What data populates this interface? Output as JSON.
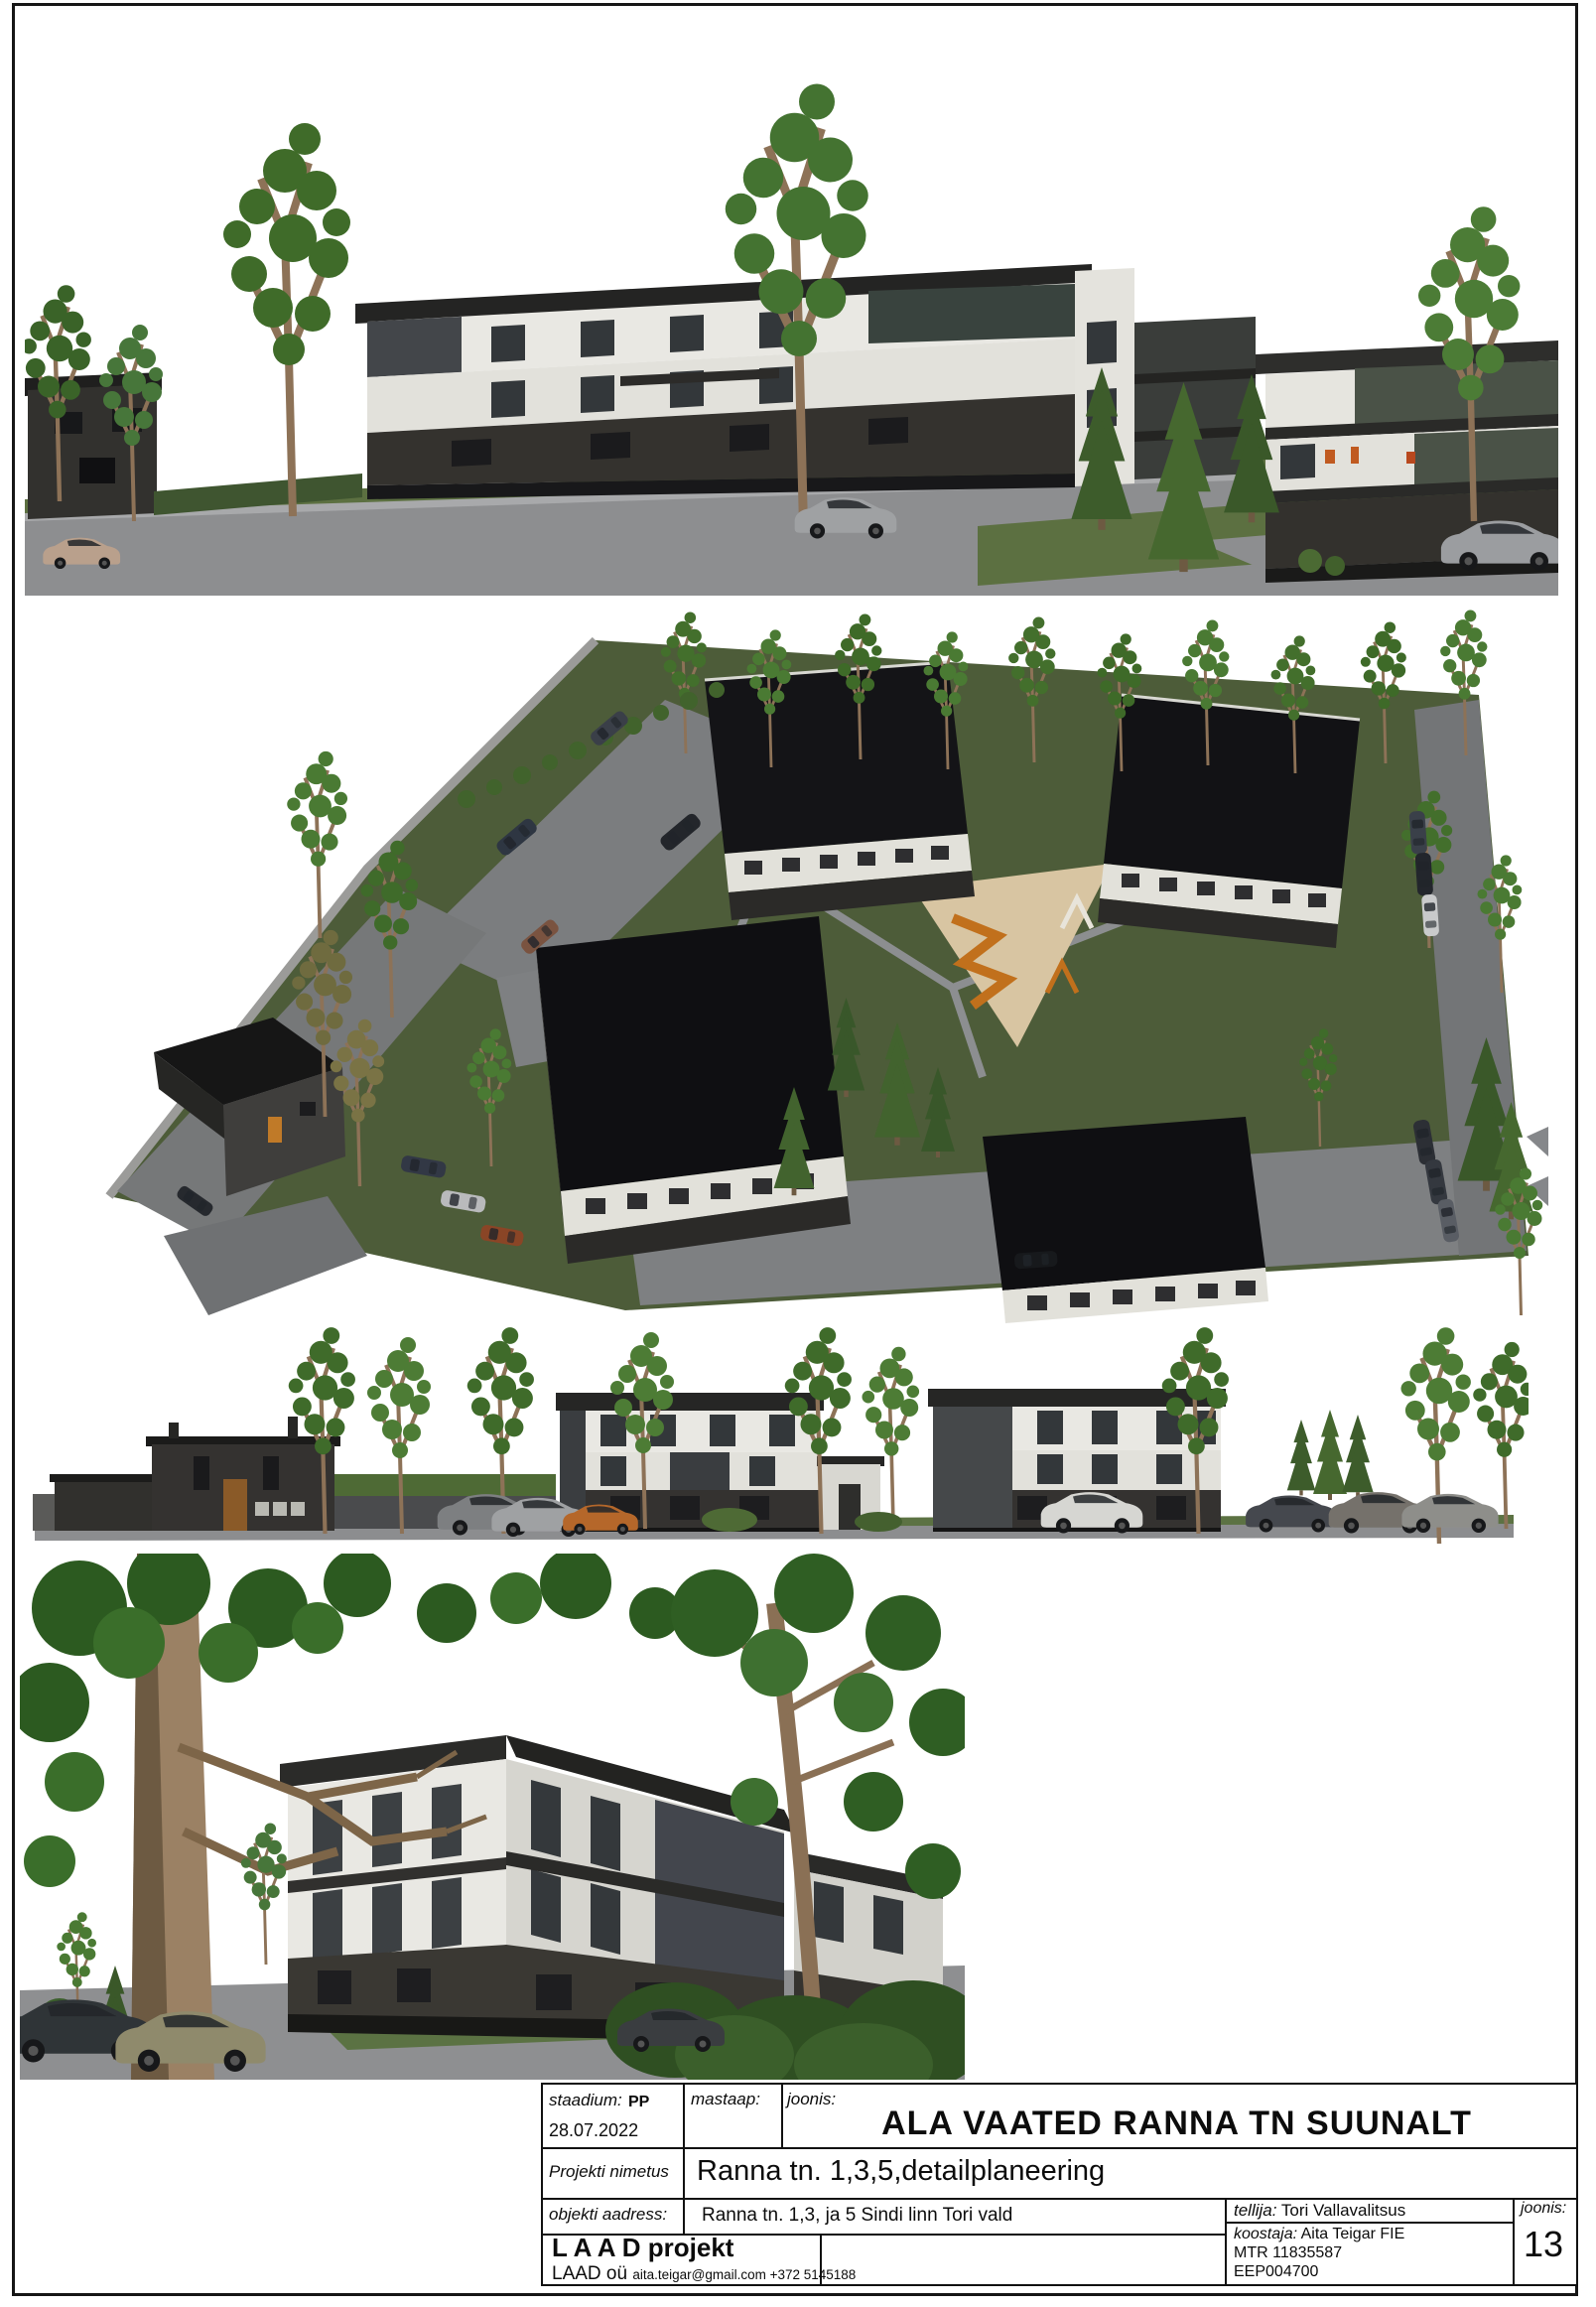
{
  "sheet": {
    "background": "#ffffff",
    "frame_color": "#161616"
  },
  "views": {
    "street_perspective": "Street-level perspective rendering of planned apartment buildings along Ranna street",
    "aerial": "Aerial rendering of the planned site with four apartment buildings, parking and playground",
    "street_elevation": "Street elevation rendering with existing house and two apartment buildings",
    "corner_perspective": "Corner perspective rendering of an apartment building behind large trees"
  },
  "title_block": {
    "staadium_label": "staadium:",
    "staadium_value": "PP",
    "date": "28.07.2022",
    "mastaap_label": "mastaap:",
    "joonis_label": "joonis:",
    "drawing_title": "ALA VAATED RANNA TN SUUNALT",
    "project_label": "Projekti nimetus",
    "project_name": "Ranna tn. 1,3,5,detailplaneering",
    "address_label": "objekti aadress:",
    "address_value": "Ranna tn. 1,3, ja 5  Sindi linn Tori vald",
    "client_label": "tellija:",
    "client_value": "Tori Vallavalitsus",
    "sheet_label": "joonis:",
    "sheet_number": "13",
    "company_name": "L A A D projekt",
    "company_short": "LAAD oü",
    "company_contact": "aita.teigar@gmail.com +372 5145188",
    "author_label": "koostaja:",
    "author_value": "Aita Teigar FIE",
    "mtr_line": "MTR   11835587",
    "reg_line": "EEP004700"
  },
  "colors": {
    "facade_white": "#e9e8e3",
    "facade_panel_dark": "#3f4346",
    "brick_dark": "#35332f",
    "roof_black": "#1d1d1c",
    "grass": "#55663f",
    "asphalt": "#8b8c8e",
    "foliage": "#3e6a29",
    "trunk": "#8d7257",
    "playground_sand": "#d9c6a3",
    "playground_orange": "#c67a1e"
  }
}
